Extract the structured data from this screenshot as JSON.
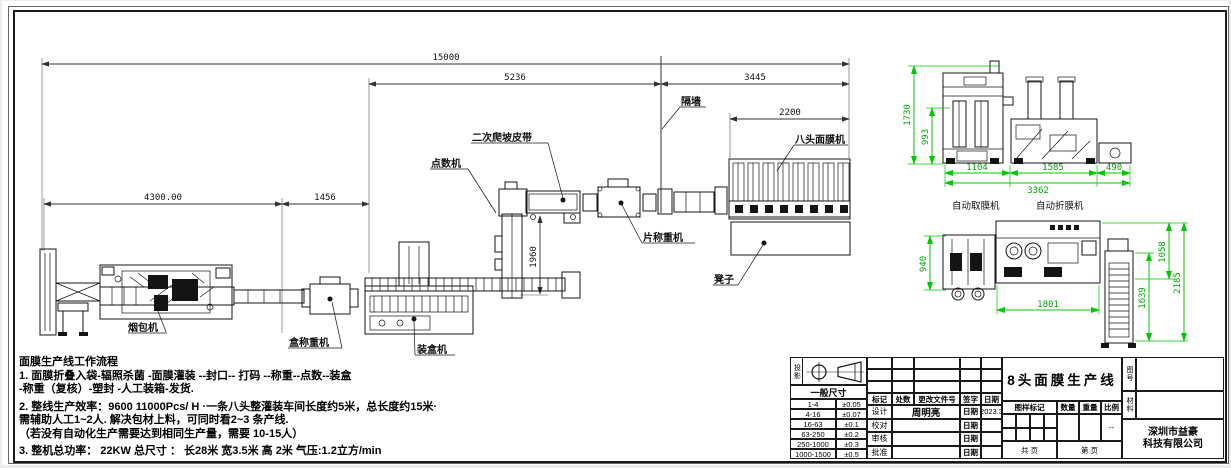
{
  "main_view": {
    "dims": {
      "total": "15000",
      "front_to_wall": "5236",
      "wall_to_end": "3445",
      "mask_machine_width": "2200",
      "left_section": "4300.00",
      "mid_section": "1456",
      "vertical_depth": "1960"
    },
    "labels": {
      "pack_machine": "烟包机",
      "box_weigher": "盒称重机",
      "cartoner": "装盒机",
      "counter": "点数机",
      "climb_belt": "二次爬坡皮带",
      "piece_weigher": "片称重机",
      "mask_machine": "八头面膜机",
      "stool": "凳子",
      "wall": "隔墙"
    }
  },
  "detail_top": {
    "dims": {
      "height": "1730",
      "inner_height": "993",
      "w1": "1104",
      "w2": "1585",
      "w3": "490",
      "total": "3362"
    },
    "labels": {
      "left": "自动取膜机",
      "right": "自动折膜机"
    }
  },
  "detail_bottom": {
    "dims": {
      "height_left": "940",
      "width": "1801",
      "h1": "1058",
      "h2": "1639",
      "h_total": "2185"
    }
  },
  "notes": {
    "title": "面膜生产线工作流程",
    "line1": "1. 面膜折叠入袋-辐照杀菌 -面膜灌装 --封口--  打码 --称重--点数--装盒",
    "line2": "-称重（复核）-塑封 -人工装箱-发货.",
    "line3": "2. 整线生产效率：9600  11000Pcs/ H  ·一条八头整灌装车间长度约5米，总长度约15米·",
    "line4": "需辅助人工1~2人. 解决包材上料，可同时看2~3  条产线.",
    "line5": "（若没有自动化生产需要达到相同生产量，需要 10-15人）",
    "line6": "3. 整机总功率：  22KW    总尺寸 ：  长28米  宽3.5米  高 2米    气压:1.2立方/min"
  },
  "title_block": {
    "projection_label": "投影",
    "general_dim_header": "一般尺寸",
    "tolerances": [
      {
        "range": "1-4",
        "tol": "±0.05"
      },
      {
        "range": "4-16",
        "tol": "±0.07"
      },
      {
        "range": "16-63",
        "tol": "±0.1"
      },
      {
        "range": "63-250",
        "tol": "±0.2"
      },
      {
        "range": "250-1000",
        "tol": "±0.3"
      },
      {
        "range": "1000-1500",
        "tol": "±0.5"
      }
    ],
    "revision_header": {
      "mark": "标记",
      "count": "处数",
      "doc": "更改文件号",
      "sign": "签字",
      "date": "日期"
    },
    "signature_rows": [
      {
        "role": "设计",
        "name": "周明亮",
        "date_label": "日期",
        "date": "2023.3"
      },
      {
        "role": "校对",
        "name": "",
        "date_label": "日期",
        "date": ""
      },
      {
        "role": "审核",
        "name": "",
        "date_label": "日期",
        "date": ""
      },
      {
        "role": "批准",
        "name": "",
        "date_label": "日期",
        "date": ""
      }
    ],
    "drawing_title": "8头面膜生产线",
    "stamp_header": {
      "mark": "图样标记",
      "qty": "数量",
      "weight": "重量",
      "scale": "比例"
    },
    "scale_value": "--",
    "sheet_total": "共  页",
    "sheet_no": "第  页",
    "drawing_no_label": "图号",
    "material_label": "材料",
    "company_line1": "深圳市益豪",
    "company_line2": "科技有限公司"
  }
}
